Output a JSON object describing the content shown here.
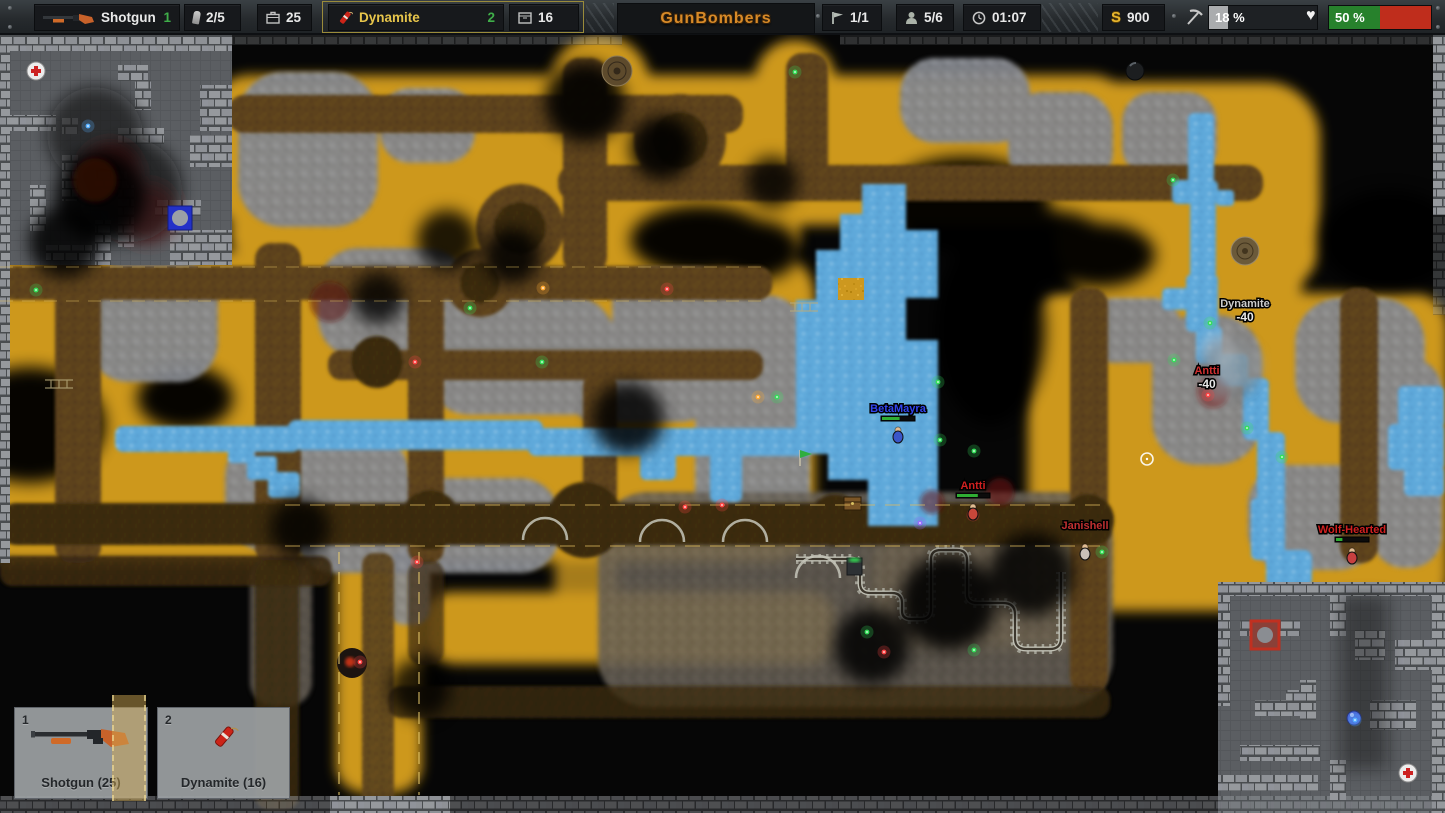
{
  "hud": {
    "weapon": {
      "slot": "1",
      "name": "Shotgun",
      "ammo": "2/5",
      "reserve": "25"
    },
    "selected": {
      "slot": "2",
      "name": "Dynamite",
      "reserve": "16"
    },
    "logo": "GunBombers",
    "flags": "1/1",
    "players": "5/6",
    "time": "01:07",
    "money": "900",
    "drill": {
      "label": "18 %",
      "pct": 18
    },
    "health": {
      "label": "50 %",
      "pct": 50
    }
  },
  "slots": [
    {
      "key": "1",
      "label": "Shotgun (25)"
    },
    {
      "key": "2",
      "label": "Dynamite (16)"
    }
  ],
  "map": {
    "players": [
      {
        "name": "BetaMayra",
        "color": "#3344ee",
        "body": "#3a56c8",
        "x": 898,
        "y": 412,
        "hp": 0.55
      },
      {
        "name": "Antti",
        "color": "#d02020",
        "body": "#c8473a",
        "x": 973,
        "y": 489,
        "hp": 0.65
      },
      {
        "name": "Janishell",
        "color": "#c03030",
        "body": "#c8c0b8",
        "x": 1085,
        "y": 529,
        "hp": null
      },
      {
        "name": "Wolf-Hearted",
        "color": "#d02020",
        "body": "#c84040",
        "x": 1352,
        "y": 533,
        "hp": 0.2
      }
    ],
    "damage": [
      {
        "name": "Dynamite",
        "ncolor": "#cccccc",
        "value": "-40",
        "x": 1245,
        "y": 307
      },
      {
        "name": "Antti",
        "ncolor": "#d03030",
        "value": "-40",
        "x": 1207,
        "y": 374
      }
    ],
    "palette": {
      "g": "#35e05a",
      "r": "#ff4545",
      "o": "#ffaa35",
      "p": "#9a6cff",
      "b": "#58b0ff"
    },
    "gems": [
      [
        36,
        290,
        "g"
      ],
      [
        795,
        72,
        "g"
      ],
      [
        470,
        308,
        "g"
      ],
      [
        542,
        362,
        "g"
      ],
      [
        415,
        362,
        "r"
      ],
      [
        667,
        289,
        "r"
      ],
      [
        543,
        288,
        "o"
      ],
      [
        758,
        397,
        "o"
      ],
      [
        777,
        397,
        "g"
      ],
      [
        938,
        382,
        "g"
      ],
      [
        940,
        440,
        "g"
      ],
      [
        974,
        451,
        "g"
      ],
      [
        685,
        507,
        "r"
      ],
      [
        722,
        505,
        "r"
      ],
      [
        417,
        562,
        "r"
      ],
      [
        867,
        632,
        "g"
      ],
      [
        884,
        652,
        "r"
      ],
      [
        974,
        650,
        "g"
      ],
      [
        973,
        515,
        "r"
      ],
      [
        920,
        523,
        "p"
      ],
      [
        1210,
        323,
        "g"
      ],
      [
        1174,
        360,
        "g"
      ],
      [
        1208,
        395,
        "r"
      ],
      [
        1173,
        180,
        "g"
      ],
      [
        1247,
        428,
        "g"
      ],
      [
        1282,
        457,
        "g"
      ],
      [
        1355,
        720,
        "b"
      ],
      [
        360,
        662,
        "r"
      ],
      [
        1102,
        552,
        "g"
      ],
      [
        88,
        126,
        "b"
      ]
    ]
  }
}
